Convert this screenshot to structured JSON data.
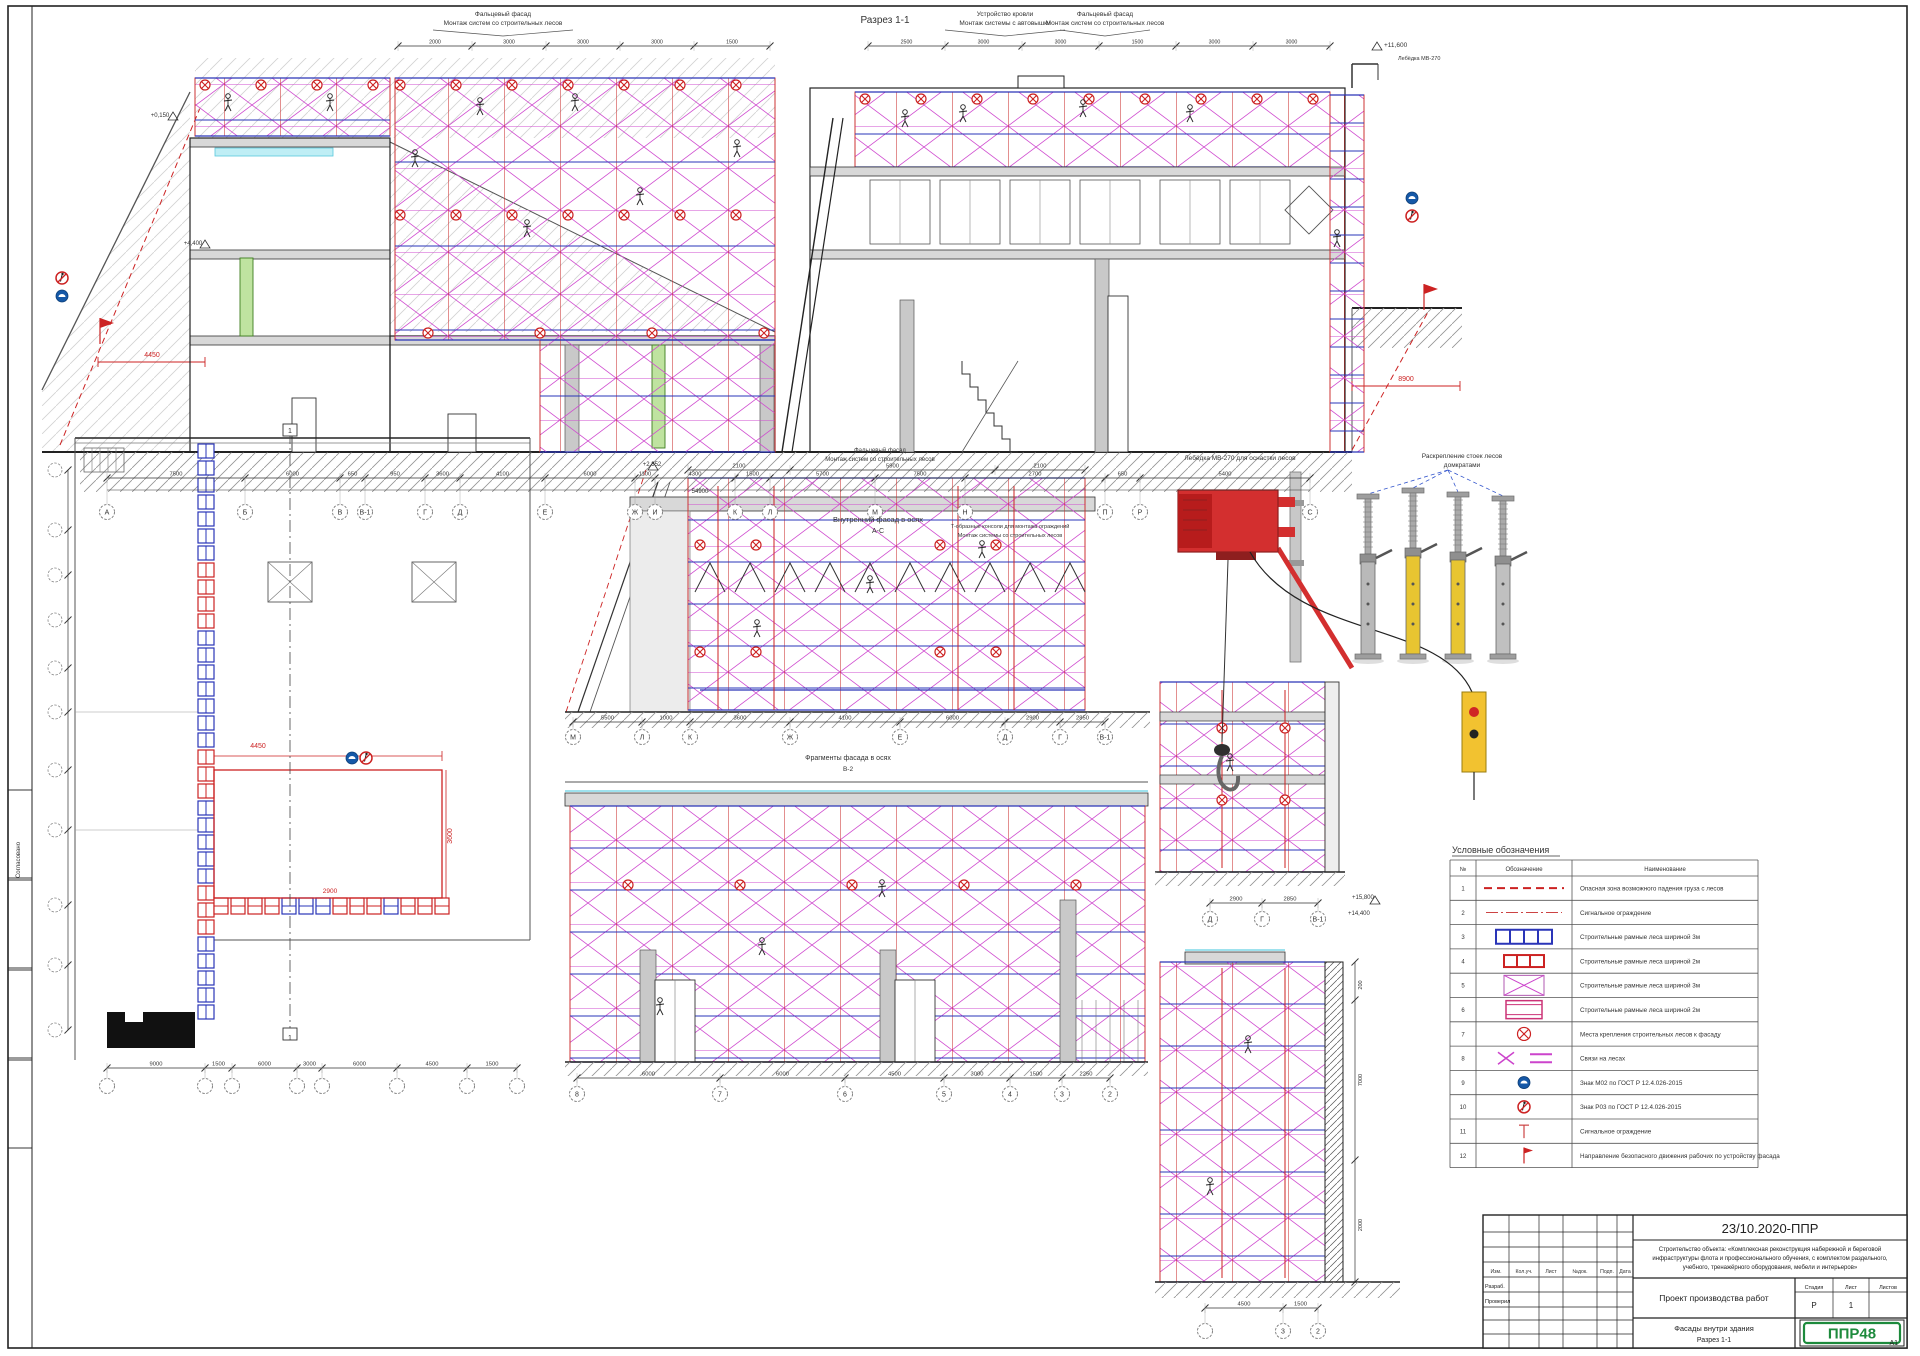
{
  "sheet": {
    "doc_code": "23/10.2020-ППР",
    "logo_text": "ППР48",
    "format_label": "А1",
    "side_stamp": "Согласовано"
  },
  "section1": {
    "title": "Разрез 1-1",
    "callout_left_l1": "Фальцевый фасад",
    "callout_left_l2": "Монтаж систем со строительных лесов",
    "callout_mid_l1": "Устройство кровли",
    "callout_mid_l2": "Монтаж системы с автовышки",
    "callout_right_l1": "Фальцевый фасад",
    "callout_right_l2": "Монтаж систем со строительных лесов",
    "roof_hoist_label": "Лебёдка МВ-270",
    "elev_left_top": "+0,150",
    "elev_left": "+4,400",
    "elev_right": "+11,600",
    "dim_red_left": "4450",
    "dim_red_right": "8900",
    "axes": [
      "А",
      "Б",
      "В",
      "В-1",
      "Г",
      "Д",
      "Е",
      "Ж",
      "И",
      "К",
      "Л",
      "М",
      "Н",
      "П",
      "Р",
      "С"
    ],
    "dims": [
      "7500",
      "6000",
      "650",
      "950",
      "3600",
      "4100",
      "6000",
      "1100",
      "4300",
      "1500",
      "5700",
      "7500",
      "2700",
      "650",
      "5400"
    ],
    "total_dim": "54900",
    "top_dims_left": [
      "2000",
      "3000",
      "3000",
      "3000",
      "1500"
    ],
    "top_dims_right": [
      "2500",
      "3000",
      "3000",
      "1500",
      "3000",
      "3000"
    ],
    "caption_l1": "Внутренний фасад в осях",
    "caption_l2": "А-С",
    "caption2_l1": "Т-образные консоли для монтажа ограждений",
    "caption2_l2": "Монтаж системы со строительных лесов"
  },
  "plan": {
    "dim_red_1": "4450",
    "dim_red_2": "3600",
    "dim_red_3": "2900",
    "section_mark": "1",
    "bottom_dims": [
      "9000",
      "1500",
      "6000",
      "3000",
      "6000",
      "4500",
      "1500"
    ],
    "bottom_axes": [
      "",
      "",
      "",
      "",
      "",
      "",
      "",
      ""
    ]
  },
  "fragA": {
    "callout_l1": "Фальцевый фасад",
    "callout_l2": "Монтаж систем со строительных лесов",
    "elev": "+2,352",
    "top_dims": [
      "2100",
      "5900",
      "2100"
    ],
    "axes": [
      "М",
      "Л",
      "К",
      "Ж",
      "Е",
      "Д",
      "Г",
      "В-1"
    ],
    "dims": [
      "5500",
      "1000",
      "3600",
      "4100",
      "6000",
      "2900",
      "2850"
    ],
    "caption_l1": "Фрагменты фасада в осях",
    "caption_l2": "В-2"
  },
  "fragB": {
    "axes": [
      "8",
      "7",
      "6",
      "5",
      "4",
      "3",
      "2"
    ],
    "dims": [
      "6000",
      "6000",
      "4500",
      "3000",
      "1500",
      "2250"
    ]
  },
  "fragC": {
    "axes": [
      "Д",
      "Г",
      "В-1"
    ],
    "dims": [
      "2900",
      "2850"
    ],
    "axes2": [
      "",
      "3",
      "2"
    ],
    "dims2": [
      "4500",
      "1500"
    ],
    "wall_dims": [
      "200",
      "7000",
      "2000"
    ],
    "elev1": "+15,800",
    "elev2": "+14,400"
  },
  "equipment": {
    "hoist_label": "Лебёдка МВ-270 для оснастки лесов",
    "jacks_label_l1": "Раскрепление стоек лесов",
    "jacks_label_l2": "домкратами"
  },
  "legend": {
    "title": "Условные обозначения",
    "col_num": "№",
    "col_sym": "Обозначение",
    "col_name": "Наименование",
    "rows": [
      {
        "n": "1",
        "name": "Опасная зона возможного падения груза с лесов"
      },
      {
        "n": "2",
        "name": "Сигнальное ограждение"
      },
      {
        "n": "3",
        "name": "Строительные рамные леса шириной 3м"
      },
      {
        "n": "4",
        "name": "Строительные рамные леса шириной 2м"
      },
      {
        "n": "5",
        "name": "Строительные рамные леса шириной 3м"
      },
      {
        "n": "6",
        "name": "Строительные рамные леса шириной 2м"
      },
      {
        "n": "7",
        "name": "Места крепления строительных лесов к фасаду"
      },
      {
        "n": "8",
        "name": "Связи на лесах"
      },
      {
        "n": "9",
        "name": "Знак М02 по ГОСТ Р 12.4.026-2015"
      },
      {
        "n": "10",
        "name": "Знак Р03 по ГОСТ Р 12.4.026-2015"
      },
      {
        "n": "11",
        "name": "Сигнальное ограждение"
      },
      {
        "n": "12",
        "name": "Направление безопасного движения рабочих по устройству фасада"
      }
    ]
  },
  "titleblock": {
    "cols": [
      "Изм.",
      "Кол.уч.",
      "Лист",
      "№док.",
      "Подп.",
      "Дата"
    ],
    "row1": "Разраб.",
    "row2": "Проверил",
    "object_l1": "Строительство объекта: «Комплексная реконструкция набережной и береговой",
    "object_l2": "инфраструктуры флота и профессионального обучения, с комплектом раздельного,",
    "object_l3": "учебного, тренажёрного оборудования, мебели и интерьеров»",
    "doc_title": "Проект производства работ",
    "sheet_title_l1": "Фасады внутри здания",
    "sheet_title_l2": "Разрез 1-1",
    "stage_label": "Стадия",
    "sheet_label": "Лист",
    "sheets_label": "Листов",
    "stage_value": "Р",
    "sheet_value": "1"
  }
}
